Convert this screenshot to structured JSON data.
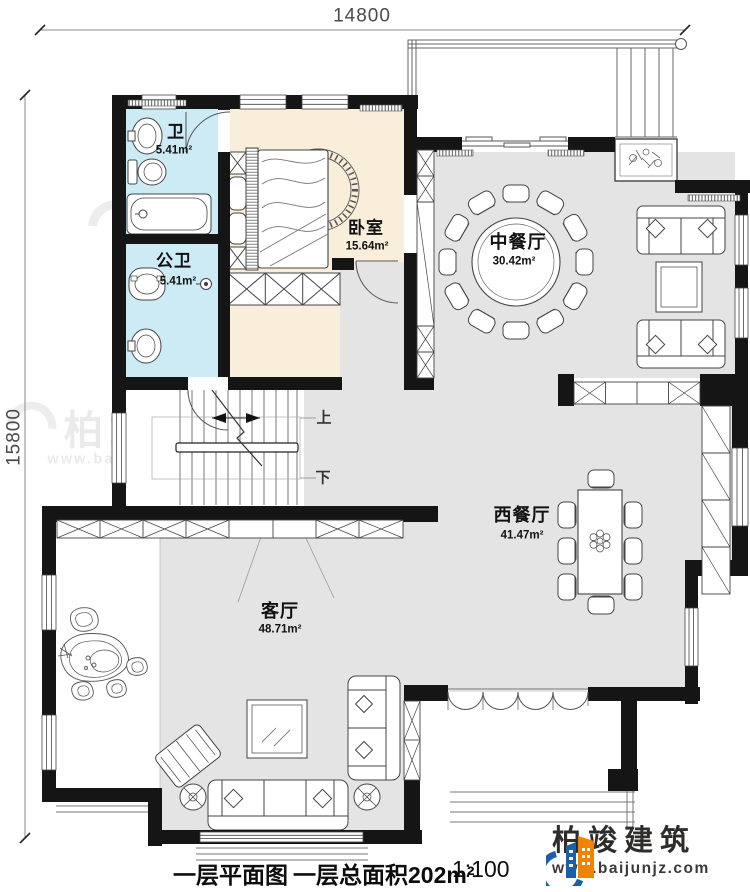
{
  "title_block": {
    "plan_name": "一层平面图",
    "total_area_label": "一层总面积202m²",
    "scale_label": "1:100"
  },
  "dimensions": {
    "width_mm": "14800",
    "height_mm": "15800"
  },
  "rooms": {
    "bath": {
      "label": "卫",
      "area": "5.41m²"
    },
    "public_bath": {
      "label": "公卫",
      "area": "5.41m²"
    },
    "bedroom": {
      "label": "卧室",
      "area": "15.64m²"
    },
    "chinese_dining": {
      "label": "中餐厅",
      "area": "30.42m²"
    },
    "western_dining": {
      "label": "西餐厅",
      "area": "41.47m²"
    },
    "living": {
      "label": "客厅",
      "area": "48.71m²"
    }
  },
  "stairs": {
    "up_label": "上",
    "down_label": "下"
  },
  "brand": {
    "name": "柏竣建筑",
    "website": "www.baijunjz.com"
  },
  "watermark": {
    "text": "柏竣建筑",
    "url": "www.baijunjz.com"
  },
  "colors": {
    "wall": "#151515",
    "floor_gray": "#e4e4e5",
    "bath_cyan": "#cdebf4",
    "bedroom_cream": "#f8eeda",
    "brand_blue": "#1b5fa8",
    "brand_orange": "#f08300"
  }
}
